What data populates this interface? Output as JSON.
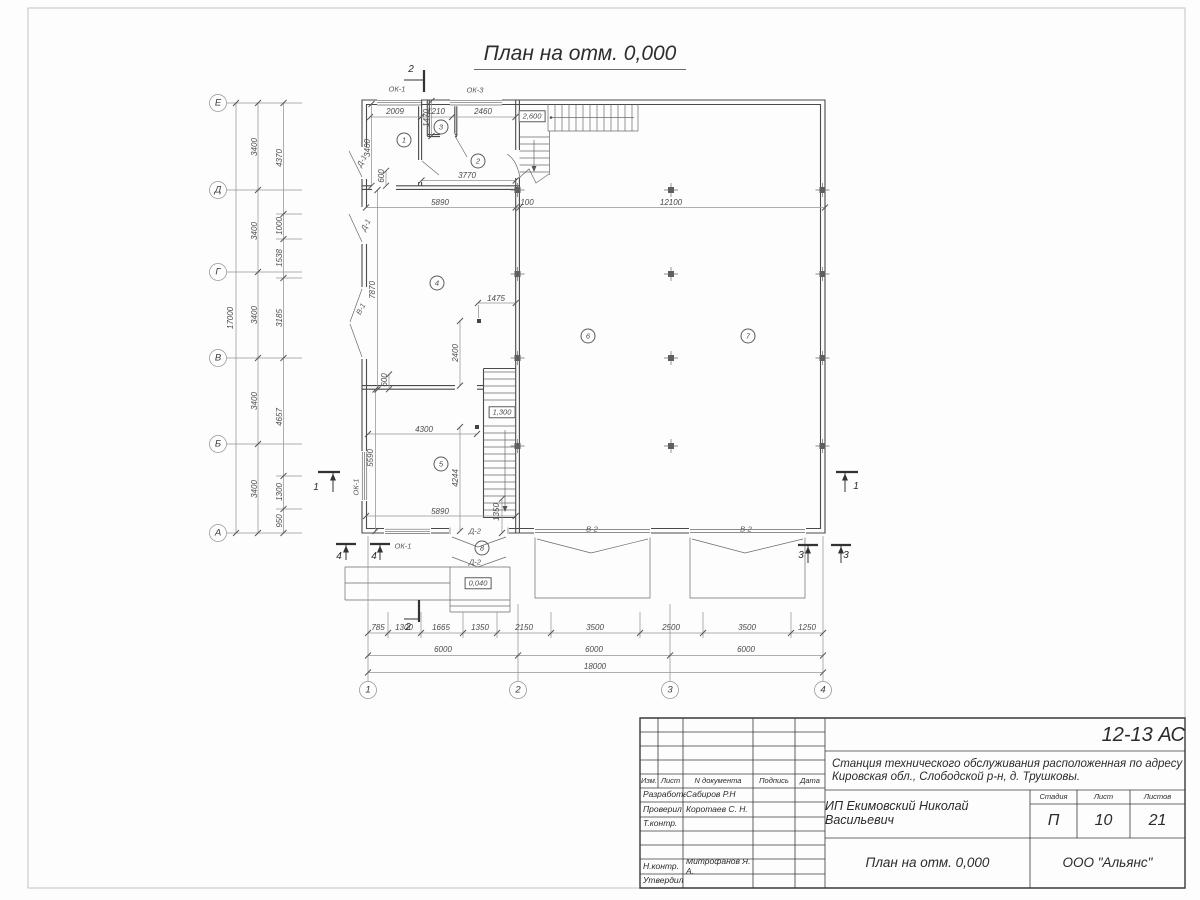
{
  "sheet": {
    "title": "План на отм. 0,000"
  },
  "axes": {
    "left": [
      "Е",
      "Д",
      "Г",
      "В",
      "Б",
      "А"
    ],
    "bottom": [
      "1",
      "2",
      "3",
      "4"
    ]
  },
  "plan": {
    "labels": [
      {
        "t": "17000",
        "x": 231,
        "y": 318,
        "r": -90
      },
      {
        "t": "3400",
        "x": 255,
        "y": 147,
        "r": -90
      },
      {
        "t": "3400",
        "x": 255,
        "y": 231,
        "r": -90
      },
      {
        "t": "3400",
        "x": 255,
        "y": 315,
        "r": -90
      },
      {
        "t": "3400",
        "x": 255,
        "y": 401,
        "r": -90
      },
      {
        "t": "3400",
        "x": 255,
        "y": 489,
        "r": -90
      },
      {
        "t": "4370",
        "x": 280,
        "y": 158,
        "r": -90
      },
      {
        "t": "1000",
        "x": 280,
        "y": 226,
        "r": -90
      },
      {
        "t": "1538",
        "x": 280,
        "y": 258,
        "r": -90
      },
      {
        "t": "3185",
        "x": 280,
        "y": 318,
        "r": -90
      },
      {
        "t": "4657",
        "x": 280,
        "y": 417,
        "r": -90
      },
      {
        "t": "1300",
        "x": 280,
        "y": 492,
        "r": -90
      },
      {
        "t": "950",
        "x": 280,
        "y": 521,
        "r": -90
      },
      {
        "t": "785",
        "x": 378,
        "y": 628
      },
      {
        "t": "1300",
        "x": 404,
        "y": 628
      },
      {
        "t": "1665",
        "x": 441,
        "y": 628
      },
      {
        "t": "1350",
        "x": 480,
        "y": 628
      },
      {
        "t": "2150",
        "x": 524,
        "y": 628
      },
      {
        "t": "3500",
        "x": 595,
        "y": 628
      },
      {
        "t": "2500",
        "x": 671,
        "y": 628
      },
      {
        "t": "3500",
        "x": 747,
        "y": 628
      },
      {
        "t": "1250",
        "x": 807,
        "y": 628
      },
      {
        "t": "6000",
        "x": 443,
        "y": 650
      },
      {
        "t": "6000",
        "x": 594,
        "y": 650
      },
      {
        "t": "6000",
        "x": 746,
        "y": 650
      },
      {
        "t": "18000",
        "x": 595,
        "y": 667
      },
      {
        "t": "2009",
        "x": 395,
        "y": 112
      },
      {
        "t": "1210",
        "x": 436,
        "y": 112
      },
      {
        "t": "2460",
        "x": 483,
        "y": 112
      },
      {
        "t": "1470",
        "x": 427,
        "y": 118,
        "r": -90
      },
      {
        "t": "5890",
        "x": 440,
        "y": 203
      },
      {
        "t": "100",
        "x": 527,
        "y": 203
      },
      {
        "t": "12100",
        "x": 671,
        "y": 203
      },
      {
        "t": "3400",
        "x": 368,
        "y": 148,
        "r": -90
      },
      {
        "t": "600",
        "x": 382,
        "y": 176,
        "r": -90
      },
      {
        "t": "3770",
        "x": 467,
        "y": 176
      },
      {
        "t": "7870",
        "x": 373,
        "y": 290,
        "r": -90
      },
      {
        "t": "1475",
        "x": 496,
        "y": 299
      },
      {
        "t": "2400",
        "x": 456,
        "y": 353,
        "r": -90
      },
      {
        "t": "600",
        "x": 385,
        "y": 380,
        "r": -90
      },
      {
        "t": "4300",
        "x": 424,
        "y": 430
      },
      {
        "t": "5590",
        "x": 371,
        "y": 458,
        "r": -90
      },
      {
        "t": "4244",
        "x": 456,
        "y": 478,
        "r": -90
      },
      {
        "t": "5890",
        "x": 440,
        "y": 512
      },
      {
        "t": "1350",
        "x": 497,
        "y": 512,
        "r": -90
      },
      {
        "t": "Е",
        "x": 218,
        "y": 103,
        "s": "axl",
        "k": "axis-label"
      },
      {
        "t": "Д",
        "x": 218,
        "y": 190,
        "s": "axl",
        "k": "axis-label"
      },
      {
        "t": "Г",
        "x": 218,
        "y": 272,
        "s": "axl",
        "k": "axis-label"
      },
      {
        "t": "В",
        "x": 218,
        "y": 358,
        "s": "axl",
        "k": "axis-label"
      },
      {
        "t": "Б",
        "x": 218,
        "y": 444,
        "s": "axl",
        "k": "axis-label"
      },
      {
        "t": "А",
        "x": 218,
        "y": 533,
        "s": "axl",
        "k": "axis-label"
      },
      {
        "t": "1",
        "x": 368,
        "y": 690,
        "s": "axl",
        "k": "axis-label"
      },
      {
        "t": "2",
        "x": 518,
        "y": 690,
        "s": "axl",
        "k": "axis-label"
      },
      {
        "t": "3",
        "x": 670,
        "y": 690,
        "s": "axl",
        "k": "axis-label"
      },
      {
        "t": "4",
        "x": 823,
        "y": 690,
        "s": "axl",
        "k": "axis-label"
      },
      {
        "t": "1",
        "x": 404,
        "y": 140,
        "s": "rm",
        "k": "room-number"
      },
      {
        "t": "3",
        "x": 441,
        "y": 127,
        "s": "rm",
        "k": "room-number"
      },
      {
        "t": "2",
        "x": 478,
        "y": 161,
        "s": "rm",
        "k": "room-number"
      },
      {
        "t": "4",
        "x": 437,
        "y": 283,
        "s": "rm",
        "k": "room-number"
      },
      {
        "t": "5",
        "x": 441,
        "y": 464,
        "s": "rm",
        "k": "room-number"
      },
      {
        "t": "6",
        "x": 588,
        "y": 336,
        "s": "rm",
        "k": "room-number"
      },
      {
        "t": "7",
        "x": 748,
        "y": 336,
        "s": "rm",
        "k": "room-number"
      },
      {
        "t": "8",
        "x": 482,
        "y": 548,
        "s": "rm",
        "k": "room-number"
      },
      {
        "t": "2,600",
        "x": 532,
        "y": 116,
        "s": "box",
        "k": "elevation-mark"
      },
      {
        "t": "1,300",
        "x": 502,
        "y": 412,
        "s": "box",
        "k": "elevation-mark"
      },
      {
        "t": "0,040",
        "x": 478,
        "y": 583,
        "s": "box",
        "k": "elevation-mark"
      },
      {
        "t": "ОК-1",
        "x": 397,
        "y": 89,
        "s": "door",
        "k": "window-label"
      },
      {
        "t": "ОК-3",
        "x": 475,
        "y": 90,
        "s": "door",
        "k": "window-label"
      },
      {
        "t": "Д-1",
        "x": 362,
        "y": 161,
        "r": -62,
        "s": "door",
        "k": "door-label"
      },
      {
        "t": "Д-1",
        "x": 366,
        "y": 225,
        "r": -62,
        "s": "door",
        "k": "door-label"
      },
      {
        "t": "В-1",
        "x": 361,
        "y": 309,
        "r": -62,
        "s": "door",
        "k": "door-label"
      },
      {
        "t": "ОК-1",
        "x": 356,
        "y": 487,
        "r": -90,
        "s": "door",
        "k": "window-label"
      },
      {
        "t": "ОК-1",
        "x": 403,
        "y": 546,
        "s": "door",
        "k": "window-label"
      },
      {
        "t": "Д-2",
        "x": 475,
        "y": 531,
        "s": "door",
        "k": "door-label"
      },
      {
        "t": "Д-2",
        "x": 475,
        "y": 562,
        "s": "door",
        "k": "door-label"
      },
      {
        "t": "В-2",
        "x": 592,
        "y": 529,
        "s": "door",
        "k": "door-label"
      },
      {
        "t": "В-2",
        "x": 746,
        "y": 529,
        "s": "door",
        "k": "door-label"
      },
      {
        "t": "2",
        "x": 411,
        "y": 70,
        "s": "sec",
        "k": "section-label"
      },
      {
        "t": "2",
        "x": 408,
        "y": 628,
        "s": "sec",
        "k": "section-label"
      },
      {
        "t": "1",
        "x": 316,
        "y": 488,
        "s": "sec",
        "k": "section-label"
      },
      {
        "t": "1",
        "x": 856,
        "y": 487,
        "s": "sec",
        "k": "section-label"
      },
      {
        "t": "3",
        "x": 801,
        "y": 556,
        "s": "sec",
        "k": "section-label"
      },
      {
        "t": "3",
        "x": 846,
        "y": 556,
        "s": "sec",
        "k": "section-label"
      },
      {
        "t": "4",
        "x": 339,
        "y": 557,
        "s": "sec",
        "k": "section-label"
      },
      {
        "t": "4",
        "x": 374,
        "y": 557,
        "s": "sec",
        "k": "section-label"
      }
    ]
  },
  "title_block": {
    "code": "12-13 АС",
    "project_line1": "Станция технического обслуживания расположенная по адресу",
    "project_line2": "Кировская обл., Слободской р-н, д. Трушковы.",
    "client": "ИП Екимовский Николай Васильевич",
    "drawing_title": "План на отм. 0,000",
    "organization": "ООО \"Альянс\"",
    "columns": {
      "izm": "Изм.",
      "list": "Лист",
      "doc": "N документа",
      "sign": "Подпись",
      "date": "Дата"
    },
    "roles": {
      "developed": "Разработал",
      "checked": "Проверил",
      "tcontrol": "Т.контр.",
      "ncontrol": "Н.контр.",
      "approved": "Утвердил"
    },
    "people": {
      "developed": "Сабиров Р.Н",
      "checked": "Коротаев С. Н.",
      "ncontrol": "Митрофанов Я. А."
    },
    "stage_label": "Стадия",
    "sheet_label": "Лист",
    "sheets_label": "Листов",
    "stage": "П",
    "sheet": "10",
    "sheets": "21"
  },
  "colors": {
    "line": "#4a4a4a",
    "dim_line": "#949494",
    "frame": "#c4c4c4",
    "text": "#2b2b2b"
  }
}
